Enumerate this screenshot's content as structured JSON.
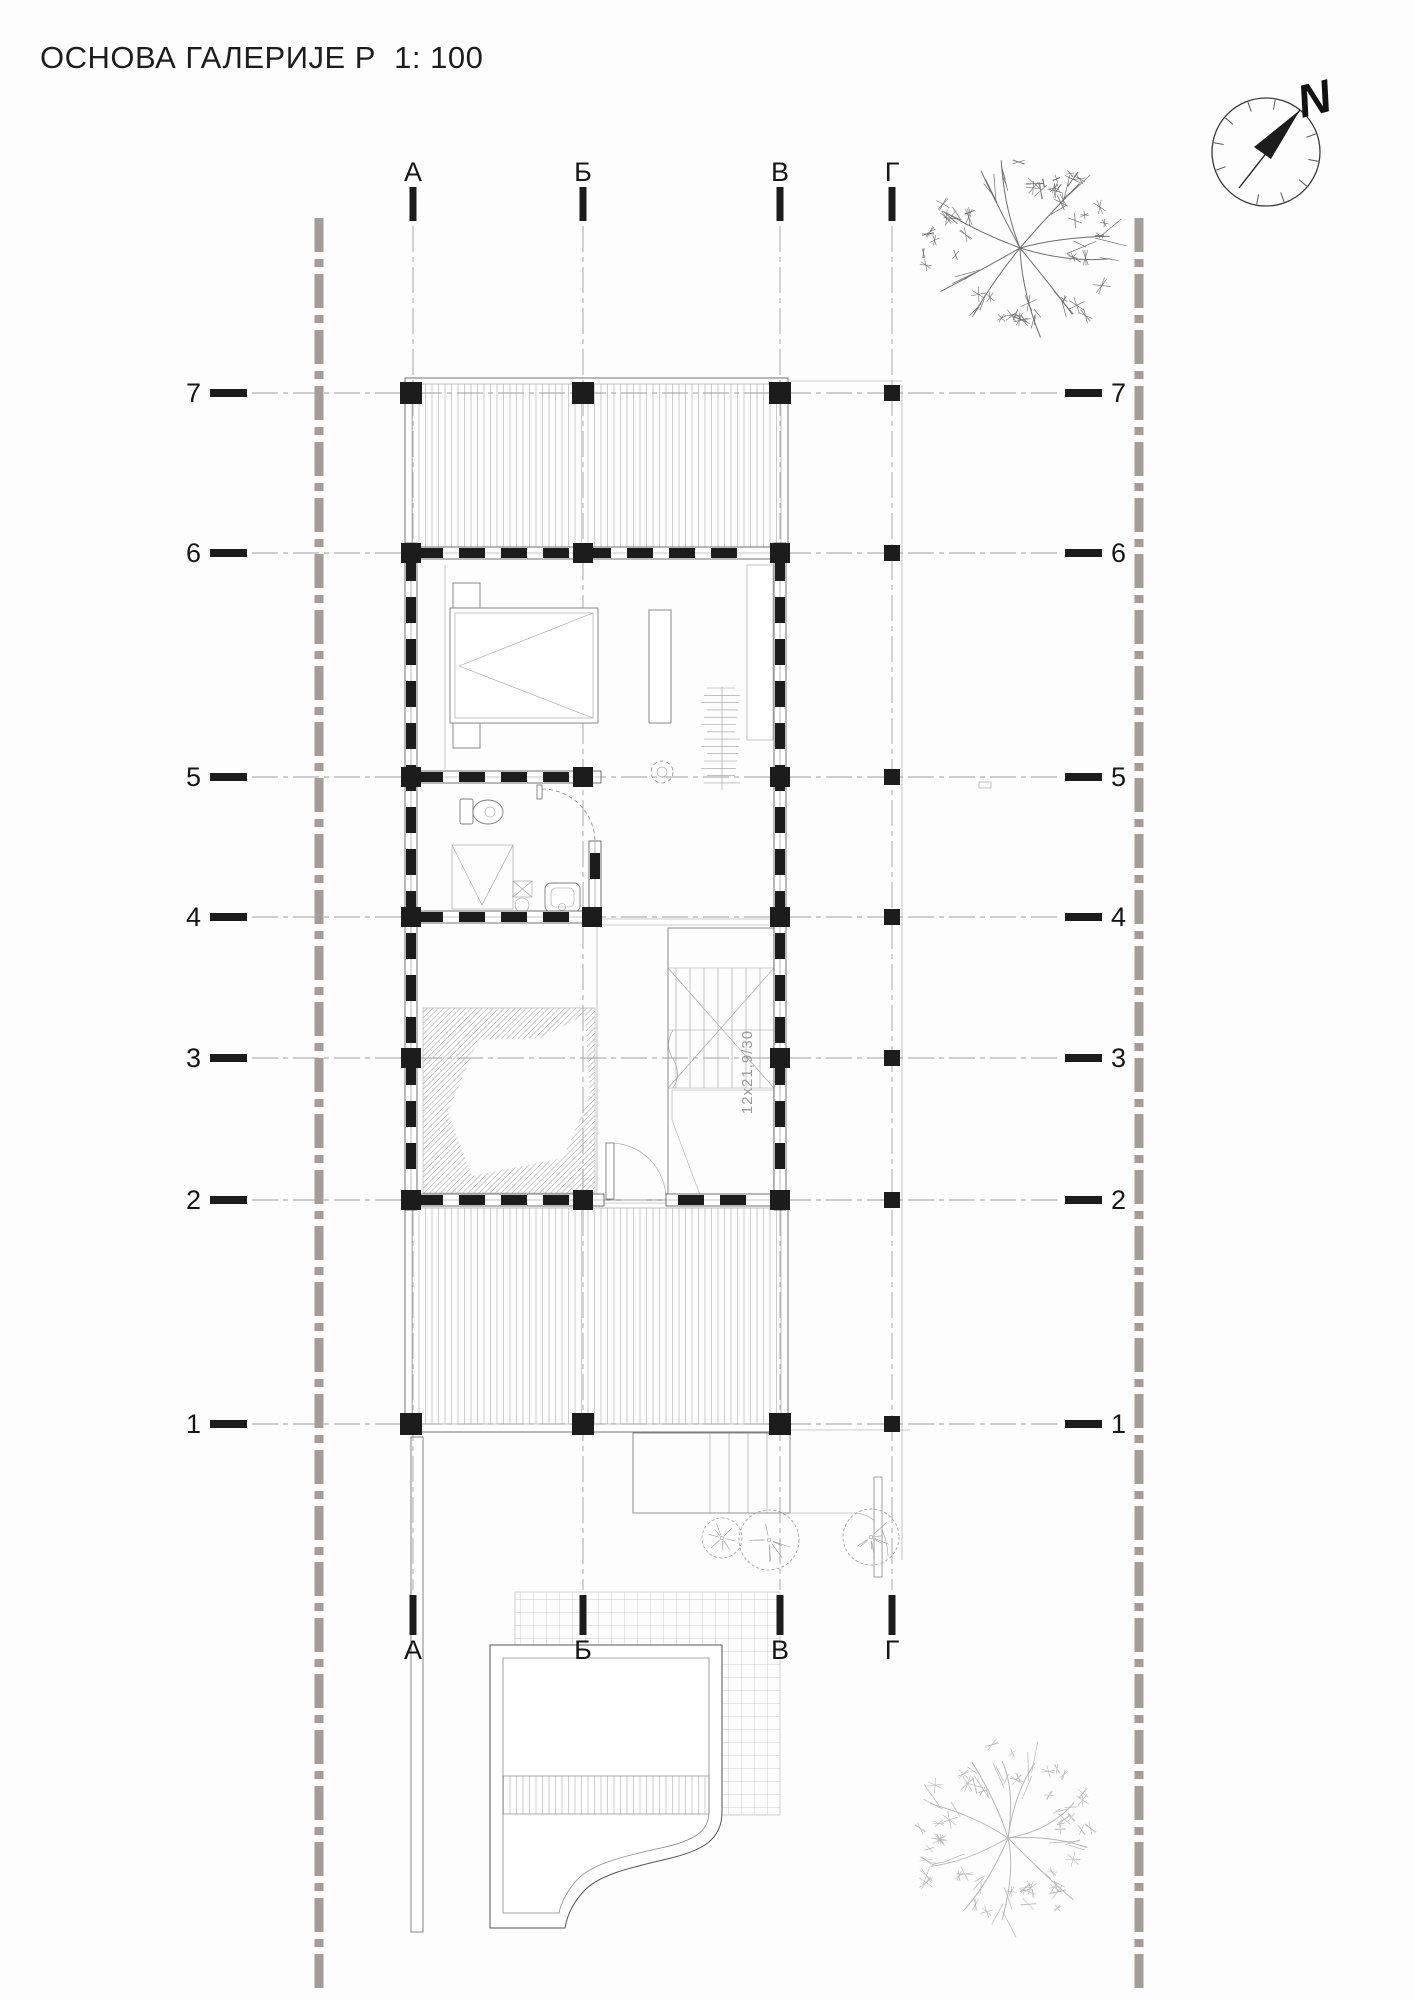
{
  "title": "ОСНОВА ГАЛЕРИЈЕ Р  1: 100",
  "compass": {
    "north_label": "N"
  },
  "grid": {
    "columns": [
      {
        "label": "А"
      },
      {
        "label": "Б"
      },
      {
        "label": "В"
      },
      {
        "label": "Г"
      }
    ],
    "rows": [
      {
        "label": "7"
      },
      {
        "label": "6"
      },
      {
        "label": "5"
      },
      {
        "label": "4"
      },
      {
        "label": "3"
      },
      {
        "label": "2"
      },
      {
        "label": "1"
      }
    ]
  },
  "stairs": {
    "note": "12x21,9/30"
  },
  "colors": {
    "paper": "#fdfdfd",
    "ink": "#1c1c1c",
    "grid_line": "#a0a0a0",
    "hatch_line": "#a3a3a3",
    "boundary_dash": "#a49c96",
    "tree_dark": "#6e6e6e",
    "tree_light": "#b7b7b7",
    "bush": "#9a9a9a"
  }
}
